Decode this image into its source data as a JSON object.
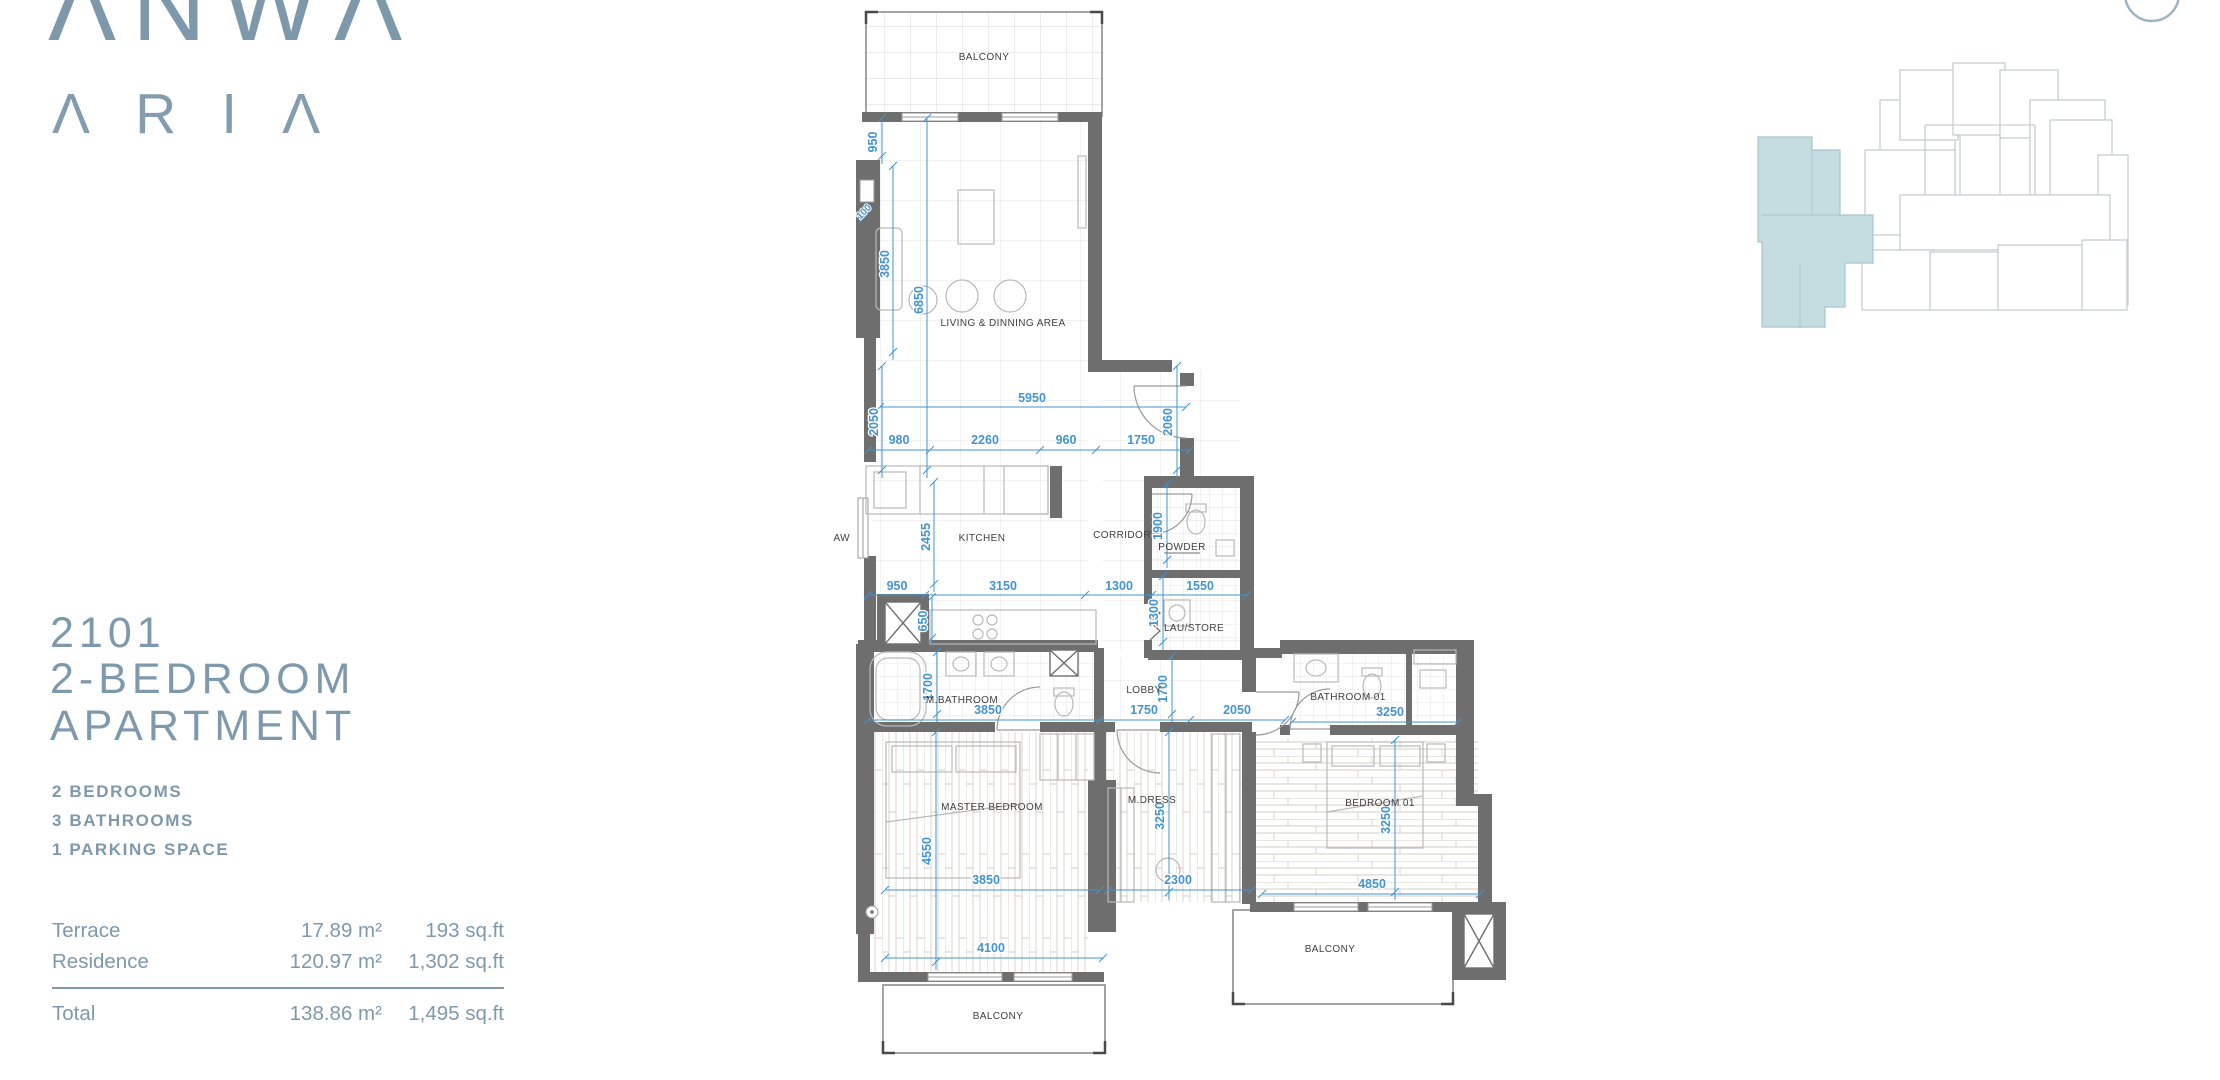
{
  "brand": {
    "name_top": "ΛNWΛ",
    "name_bottom": "ΛRIΛ"
  },
  "unit": {
    "number": "2101",
    "type_line1": "2-BEDROOM",
    "type_line2": "APARTMENT"
  },
  "features": {
    "bedrooms": "2 BEDROOMS",
    "bathrooms": "3 BATHROOMS",
    "parking": "1 PARKING SPACE"
  },
  "areas": {
    "terrace_label": "Terrace",
    "terrace_m2": "17.89 m²",
    "terrace_sqft": "193 sq.ft",
    "residence_label": "Residence",
    "residence_m2": "120.97 m²",
    "residence_sqft": "1,302 sq.ft",
    "total_label": "Total",
    "total_m2": "138.86 m²",
    "total_sqft": "1,495 sq.ft"
  },
  "plan": {
    "rooms": {
      "balcony_top": "BALCONY",
      "living": "LIVING & DINNING AREA",
      "kitchen": "KITCHEN",
      "corridor": "CORRIDOR",
      "powder": "POWDER",
      "laustore": "LAU/STORE",
      "aw": "AW",
      "mbath": "M.BATHROOM",
      "lobby": "LOBBY",
      "bath01": "BATHROOM 01",
      "master": "MASTER BEDROOM",
      "mdress": "M.DRESS",
      "bed01": "BEDROOM 01",
      "balcony_bl": "BALCONY",
      "balcony_br": "BALCONY"
    },
    "dims": {
      "d950v": "950",
      "d100": "100",
      "d3850v": "3850",
      "d6850": "6850",
      "d2050v": "2050",
      "d5950": "5950",
      "d980": "980",
      "d2260": "2260",
      "d960": "960",
      "d1750a": "1750",
      "d2060": "2060",
      "d2455": "2455",
      "d950h": "950",
      "d3150": "3150",
      "d1300h": "1300",
      "d1550": "1550",
      "d1900": "1900",
      "d650": "650",
      "d1300v": "1300",
      "d1700a": "1700",
      "d1700b": "1700",
      "d3850h": "3850",
      "d1750b": "1750",
      "d2050h": "2050",
      "d3250a": "3250",
      "d4550": "4550",
      "d3250b": "3250",
      "d3250c": "3250",
      "d3850m": "3850",
      "d2300": "2300",
      "d4850": "4850",
      "d4100": "4100"
    }
  },
  "colors": {
    "accent": "#7e99ac",
    "dimension_blue": "#4394cf",
    "wall_gray": "#6e6e6e",
    "keyplan_highlight": "#c5dde1"
  }
}
